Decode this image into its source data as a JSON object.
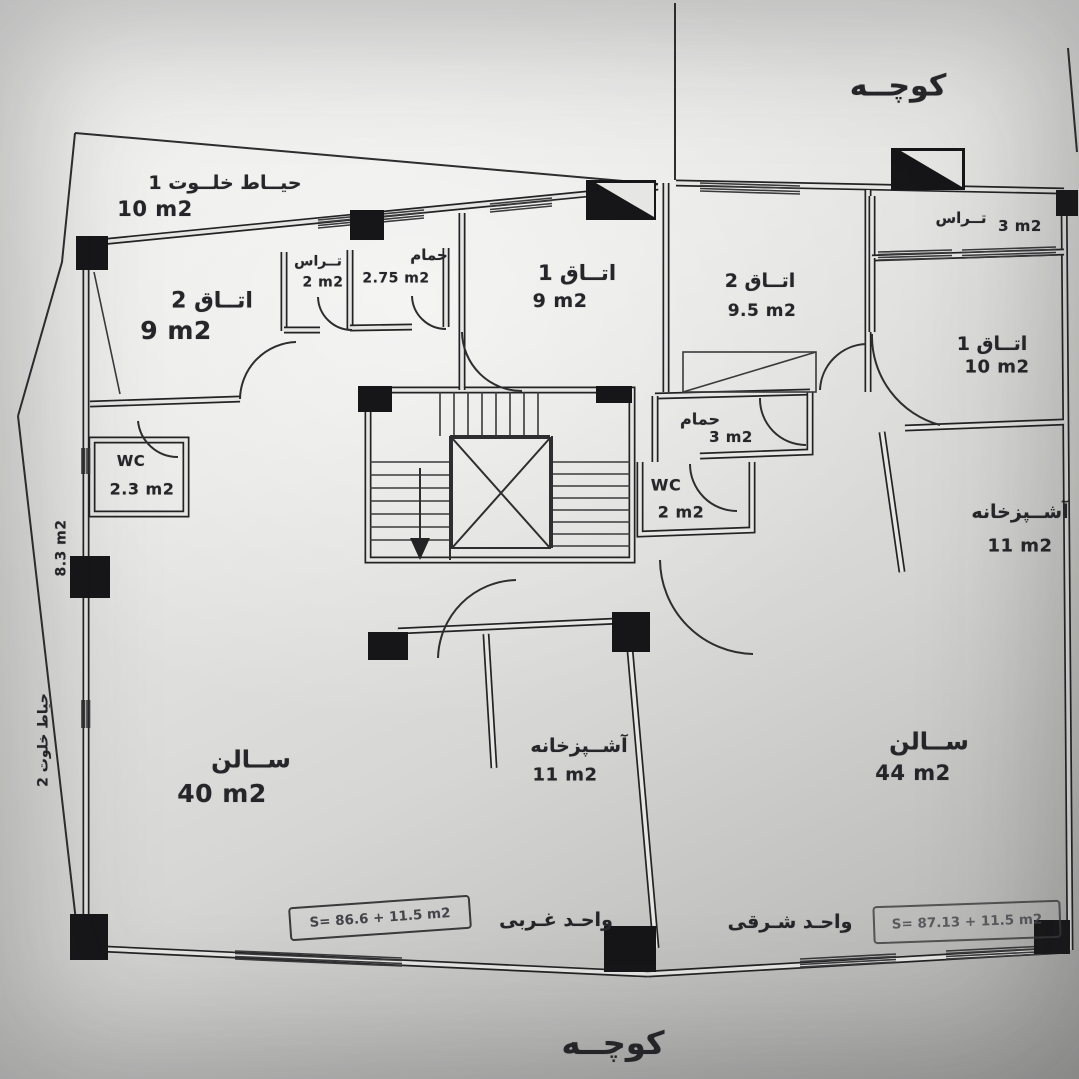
{
  "streets": {
    "top_alley": "کوچــه",
    "bottom_alley": "کوچــه"
  },
  "left_strip": {
    "name": "حیاط خلوت 2",
    "area": "8.3 m2"
  },
  "west_unit": {
    "label": "واحـد غـربی",
    "area_formula": "S= 86.6 + 11.5 m2",
    "rooms": {
      "yard": {
        "name": "حیــاط خلــوت 1",
        "area": "10 m2"
      },
      "room2": {
        "name": "اتــاق 2",
        "area": "9 m2"
      },
      "terrace": {
        "name": "تــراس",
        "area": "2 m2"
      },
      "bath": {
        "name": "حمام",
        "area": "2.75 m2"
      },
      "room1": {
        "name": "اتــاق 1",
        "area": "9 m2"
      },
      "wc": {
        "name": "WC",
        "area": "2.3 m2"
      },
      "salon": {
        "name": "ســالن",
        "area": "40 m2"
      },
      "kitchen": {
        "name": "آشــپزخانه",
        "area": "11 m2"
      }
    }
  },
  "east_unit": {
    "label": "واحـد شـرقی",
    "area_formula": "S= 87.13 + 11.5 m2",
    "rooms": {
      "room2": {
        "name": "اتــاق 2",
        "area": "9.5 m2"
      },
      "terrace": {
        "name": "تــراس",
        "area": "3 m2"
      },
      "room1": {
        "name": "اتــاق 1",
        "area": "10 m2"
      },
      "bath": {
        "name": "حمام",
        "area": "3 m2"
      },
      "wc": {
        "name": "WC",
        "area": "2 m2"
      },
      "kitchen": {
        "name": "آشــپزخانه",
        "area": "11 m2"
      },
      "salon": {
        "name": "ســالن",
        "area": "44 m2"
      }
    }
  }
}
